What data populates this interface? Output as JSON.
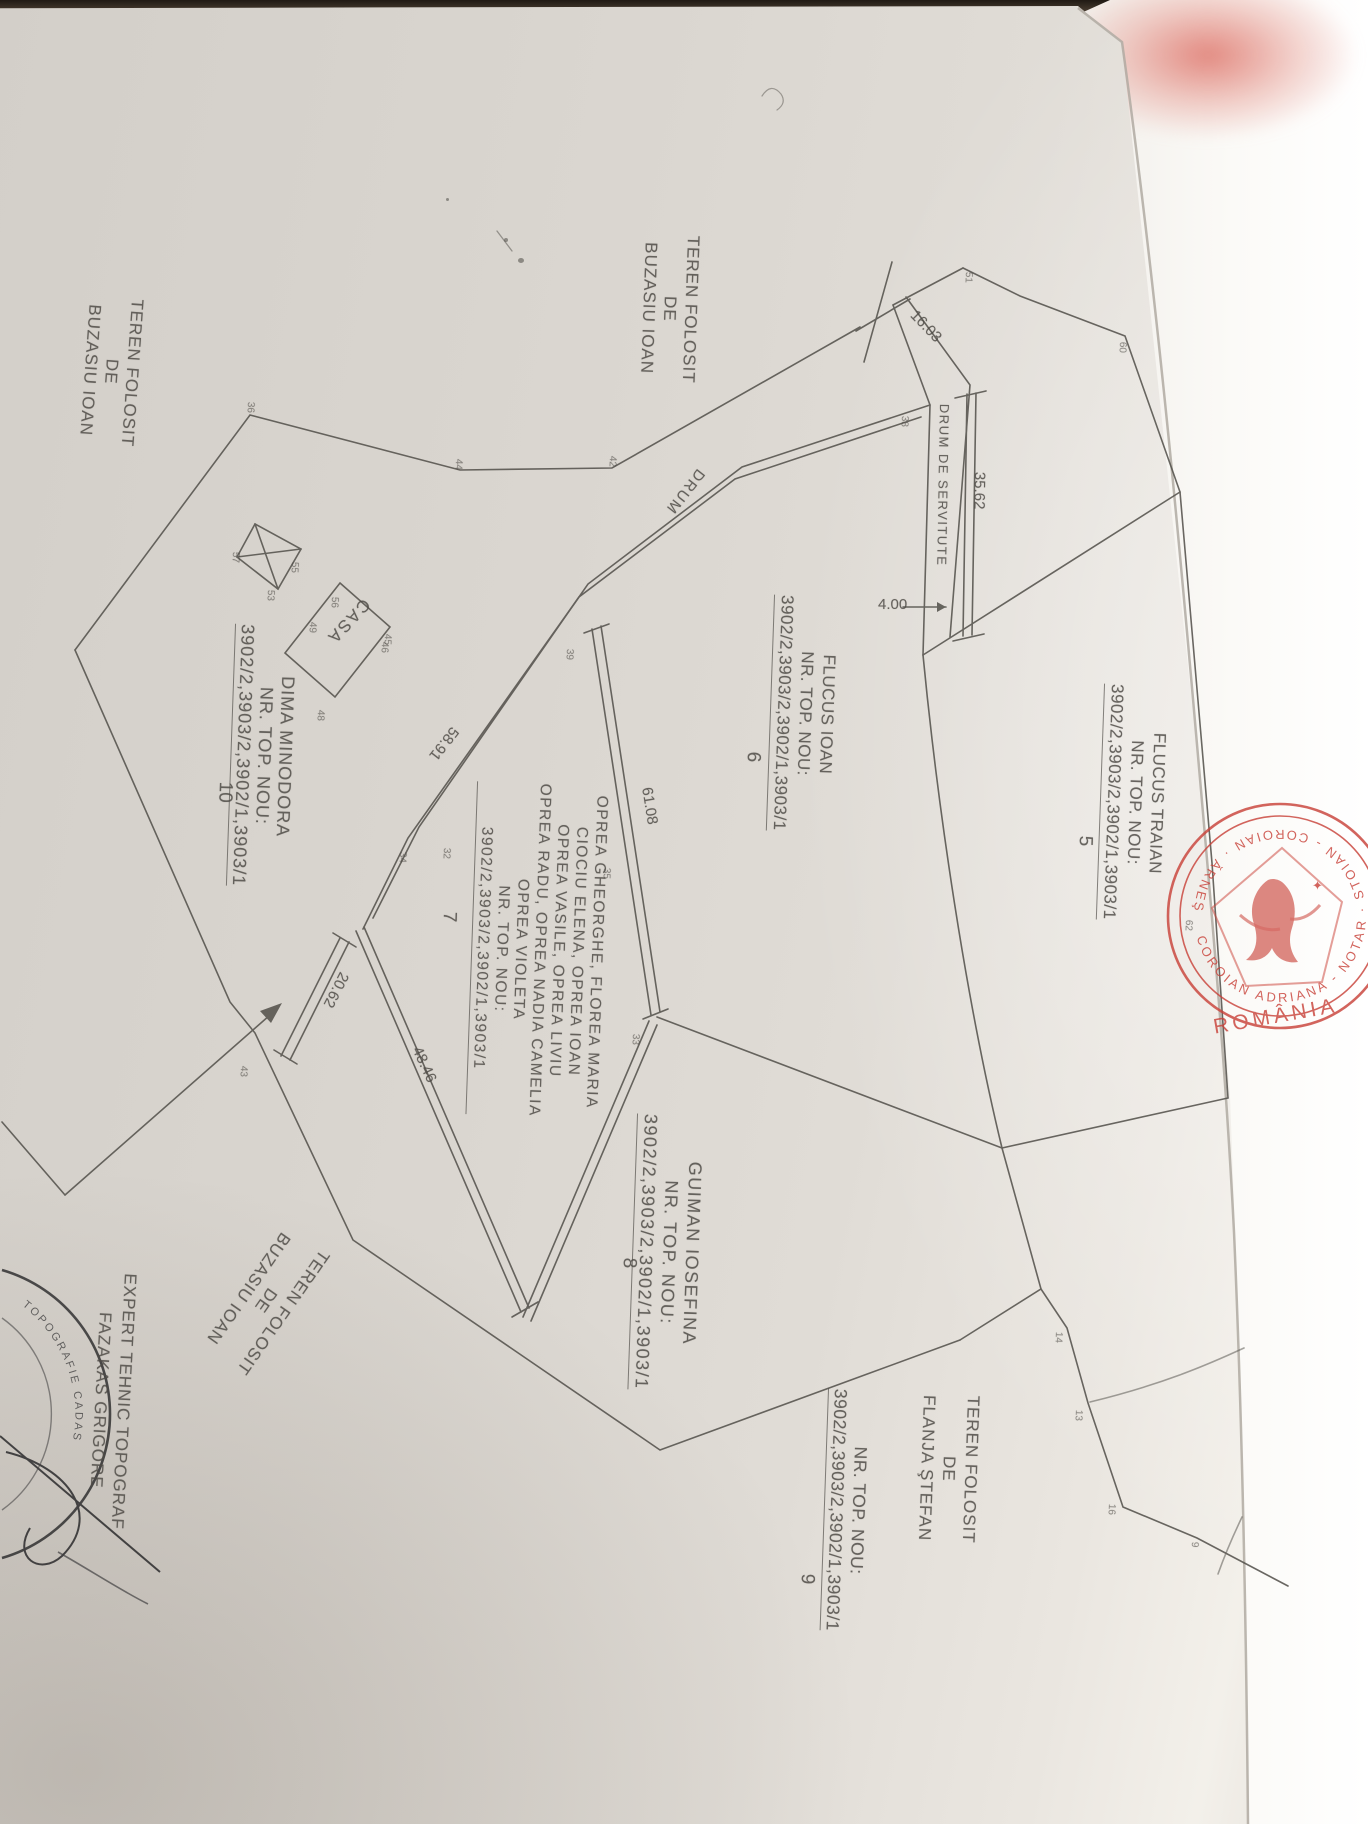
{
  "colors": {
    "ink": "#56524d",
    "stamp_red": "#c8423a",
    "paper": "#dad6d0"
  },
  "plan": {
    "labels": [
      {
        "name": "area-label-teren-folosit-top",
        "x": 704,
        "y": 236,
        "rot": 92,
        "size": 17,
        "ls": 1,
        "lh": 21,
        "lines": [
          {
            "t": "TEREN FOLOSIT"
          },
          {
            "t": "DE"
          },
          {
            "t": "BUZASIU IOAN"
          }
        ]
      },
      {
        "name": "area-label-teren-folosit-left",
        "x": 148,
        "y": 300,
        "rot": 94,
        "size": 17,
        "ls": 1,
        "lh": 21,
        "lines": [
          {
            "t": "TEREN FOLOSIT"
          },
          {
            "t": "DE"
          },
          {
            "t": "BUZASIU IOAN"
          }
        ]
      },
      {
        "name": "area-label-teren-folosit-bottom",
        "x": 334,
        "y": 1258,
        "rot": 125,
        "size": 17,
        "ls": 1,
        "lh": 21,
        "lines": [
          {
            "t": "TEREN FOLOSIT"
          },
          {
            "t": "DE"
          },
          {
            "t": "BUZASIU IOAN"
          }
        ]
      },
      {
        "name": "owner-label-flucus-traian",
        "x": 1172,
        "y": 686,
        "rot": 92,
        "size": 17,
        "ls": 0.5,
        "lh": 22,
        "lines": [
          {
            "t": "FLUCUS TRAIAN"
          },
          {
            "t": "NR. TOP. NOU:"
          },
          {
            "t": "3902/2,3903/2,3902/1,3903/1",
            "u": true
          }
        ]
      },
      {
        "name": "parcel-number-5",
        "x": 1096,
        "y": 836,
        "rot": 92,
        "size": 19,
        "ls": 0,
        "lh": 22,
        "lines": [
          {
            "t": "5"
          }
        ]
      },
      {
        "name": "owner-label-flucus-ioan",
        "x": 842,
        "y": 597,
        "rot": 92,
        "size": 17,
        "ls": 0.5,
        "lh": 22,
        "lines": [
          {
            "t": "FLUCUS IOAN"
          },
          {
            "t": "NR. TOP. NOU:"
          },
          {
            "t": "3902/2,3903/2,3902/1,3903/1",
            "u": true
          }
        ]
      },
      {
        "name": "parcel-number-6",
        "x": 764,
        "y": 752,
        "rot": 92,
        "size": 19,
        "ls": 0,
        "lh": 22,
        "lines": [
          {
            "t": "6"
          }
        ]
      },
      {
        "name": "owner-label-oprea",
        "x": 612,
        "y": 786,
        "rot": 92,
        "size": 15.5,
        "ls": 1.5,
        "lh": 19,
        "lines": [
          {
            "t": "OPREA GHEORGHE, FLOREA MARIA"
          },
          {
            "t": "CIOCIU ELENA, OPREA IOAN"
          },
          {
            "t": "OPREA VASILE, OPREA LIVIU"
          },
          {
            "t": "OPREA RADU, OPREA NADIA CAMELIA"
          },
          {
            "t": "OPREA VIOLETA"
          },
          {
            "t": "NR. TOP. NOU:"
          },
          {
            "t": "3902/2,3903/2,3902/1,3903/1",
            "u": true
          }
        ]
      },
      {
        "name": "parcel-number-7",
        "x": 460,
        "y": 912,
        "rot": 92,
        "size": 19,
        "ls": 0,
        "lh": 22,
        "lines": [
          {
            "t": "7"
          }
        ]
      },
      {
        "name": "owner-label-guiman",
        "x": 708,
        "y": 1116,
        "rot": 92,
        "size": 18,
        "ls": 1.5,
        "lh": 23,
        "lines": [
          {
            "t": "GUIMAN IOSEFINA"
          },
          {
            "t": "NR. TOP. NOU:"
          },
          {
            "t": "3902/2,3903/2,3902/1,3903/1",
            "u": true
          }
        ]
      },
      {
        "name": "parcel-number-8",
        "x": 640,
        "y": 1258,
        "rot": 92,
        "size": 19,
        "ls": 0,
        "lh": 22,
        "lines": [
          {
            "t": "8"
          }
        ]
      },
      {
        "name": "owner-label-dima",
        "x": 300,
        "y": 626,
        "rot": 92,
        "size": 18,
        "ls": 1,
        "lh": 21,
        "lines": [
          {
            "t": "DIMA MINODORA"
          },
          {
            "t": "NR. TOP. NOU:"
          },
          {
            "t": "3902/2,3903/2,3902/1,3903/1",
            "u": true
          }
        ]
      },
      {
        "name": "parcel-number-10",
        "x": 236,
        "y": 782,
        "rot": 92,
        "size": 19,
        "ls": 0,
        "lh": 22,
        "lines": [
          {
            "t": "10"
          }
        ]
      },
      {
        "name": "area-label-flanja",
        "x": 984,
        "y": 1396,
        "rot": 92,
        "size": 17,
        "ls": 1,
        "lh": 22,
        "lines": [
          {
            "t": "TEREN FOLOSIT"
          },
          {
            "t": "DE"
          },
          {
            "t": "FLANJA ŞTEFAN"
          }
        ]
      },
      {
        "name": "parcel-ref-9-block",
        "x": 874,
        "y": 1390,
        "rot": 92,
        "size": 17.5,
        "ls": 0.5,
        "lh": 22,
        "lines": [
          {
            "t": "NR. TOP. NOU:"
          },
          {
            "t": "3902/2,3903/2,3902/1,3903/1",
            "u": true
          }
        ]
      },
      {
        "name": "parcel-number-9",
        "x": 818,
        "y": 1574,
        "rot": 92,
        "size": 19,
        "ls": 0,
        "lh": 22,
        "lines": [
          {
            "t": "9"
          }
        ]
      },
      {
        "name": "surveyor-label",
        "x": 142,
        "y": 1274,
        "rot": 93,
        "size": 17,
        "ls": 1,
        "lh": 23,
        "lines": [
          {
            "t": "EXPERT TEHNIC TOPOGRAF"
          },
          {
            "t": "FAZAKAS GRIGORE"
          }
        ]
      },
      {
        "name": "house-label-casa",
        "x": 374,
        "y": 608,
        "rot": 133,
        "size": 17,
        "ls": 2,
        "lh": 20,
        "lines": [
          {
            "t": "CASA"
          }
        ]
      },
      {
        "name": "road-label-drum-servitute",
        "x": 952,
        "y": 404,
        "rot": 91,
        "size": 13,
        "ls": 1.5,
        "lh": 16,
        "lines": [
          {
            "t": "DRUM DE SERVITUTE"
          }
        ]
      },
      {
        "name": "road-label-drum",
        "x": 708,
        "y": 476,
        "rot": 128,
        "size": 15,
        "ls": 2,
        "lh": 18,
        "lines": [
          {
            "t": "DRUM"
          }
        ]
      }
    ],
    "dimensions": [
      {
        "t": "16.03",
        "x": 919,
        "y": 307,
        "rot": 46
      },
      {
        "t": "35.62",
        "x": 988,
        "y": 472,
        "rot": 91
      },
      {
        "t": "4.00",
        "x": 878,
        "y": 596,
        "rot": 0
      },
      {
        "t": "58.91",
        "x": 462,
        "y": 734,
        "rot": 128
      },
      {
        "t": "61.08",
        "x": 655,
        "y": 786,
        "rot": 81
      },
      {
        "t": "48.46",
        "x": 424,
        "y": 1044,
        "rot": 65
      },
      {
        "t": "20.62",
        "x": 352,
        "y": 977,
        "rot": 117
      }
    ],
    "vertices": [
      {
        "t": "51",
        "x": 974,
        "y": 272
      },
      {
        "t": "38",
        "x": 910,
        "y": 416
      },
      {
        "t": "44",
        "x": 464,
        "y": 459
      },
      {
        "t": "42",
        "x": 618,
        "y": 456
      },
      {
        "t": "36",
        "x": 256,
        "y": 402
      },
      {
        "t": "46",
        "x": 390,
        "y": 642
      },
      {
        "t": "39",
        "x": 575,
        "y": 649
      },
      {
        "t": "35",
        "x": 612,
        "y": 868
      },
      {
        "t": "33",
        "x": 641,
        "y": 1034
      },
      {
        "t": "32",
        "x": 452,
        "y": 848
      },
      {
        "t": "34",
        "x": 408,
        "y": 852
      },
      {
        "t": "55",
        "x": 300,
        "y": 562
      },
      {
        "t": "53",
        "x": 276,
        "y": 590
      },
      {
        "t": "57",
        "x": 241,
        "y": 552
      },
      {
        "t": "56",
        "x": 340,
        "y": 597
      },
      {
        "t": "49",
        "x": 318,
        "y": 622
      },
      {
        "t": "48",
        "x": 326,
        "y": 710
      },
      {
        "t": "45",
        "x": 393,
        "y": 634
      },
      {
        "t": "43",
        "x": 249,
        "y": 1066
      },
      {
        "t": "60",
        "x": 1128,
        "y": 342
      },
      {
        "t": "62",
        "x": 1194,
        "y": 920
      },
      {
        "t": "14",
        "x": 1064,
        "y": 1332
      },
      {
        "t": "13",
        "x": 1084,
        "y": 1410
      },
      {
        "t": "16",
        "x": 1117,
        "y": 1504
      },
      {
        "t": "9",
        "x": 1200,
        "y": 1542
      }
    ],
    "stamp": {
      "country": "ROMÂNIA",
      "ring": "COROIAN ADRIANA - NOTAR · STOIAN - COROIAN · ĂRNEŞTI"
    },
    "corner_stamp": {
      "text": "TOPOGRAFIE CADAS"
    }
  }
}
